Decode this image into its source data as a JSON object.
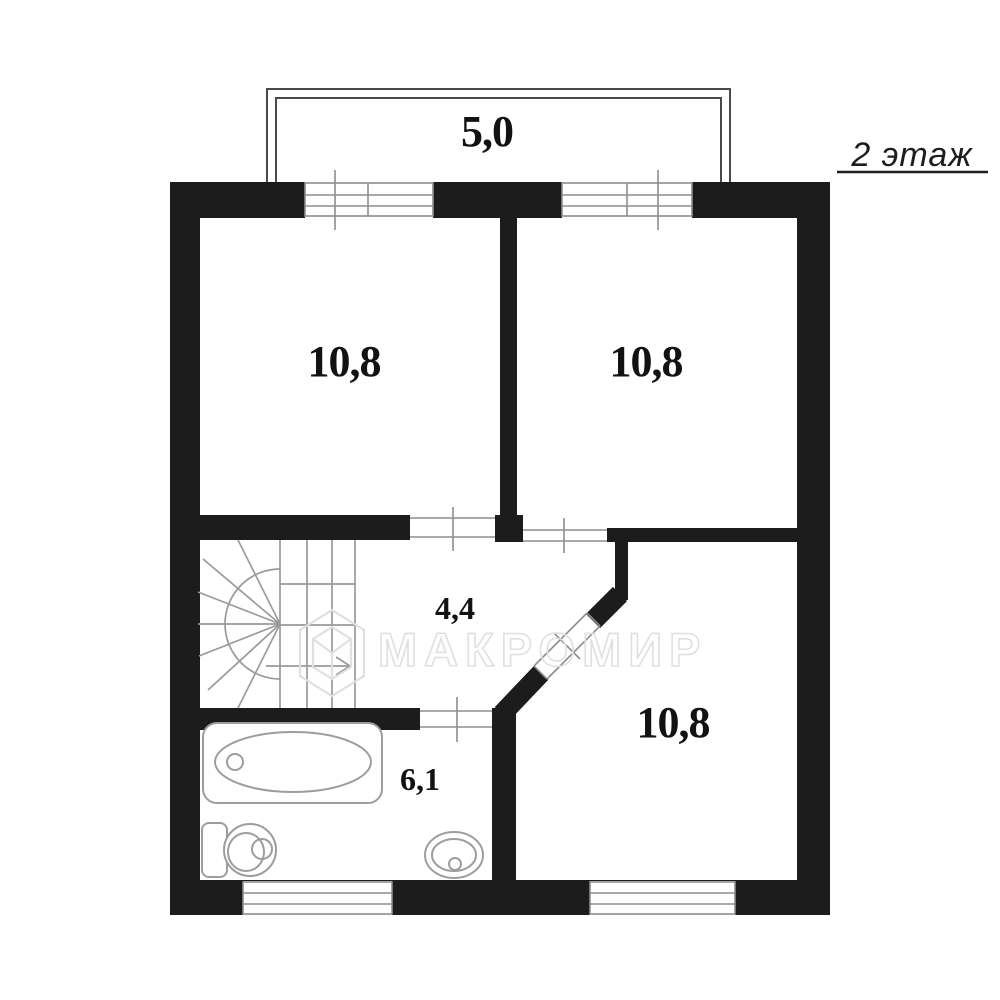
{
  "page": {
    "floor_label": "2 этаж"
  },
  "balcony": {
    "area_label": "5,0"
  },
  "rooms": {
    "top_left": {
      "area_label": "10,8"
    },
    "top_right": {
      "area_label": "10,8"
    },
    "hall": {
      "area_label": "4,4"
    },
    "bathroom": {
      "area_label": "6,1"
    },
    "bottom_right": {
      "area_label": "10,8"
    }
  },
  "watermark": {
    "text": "МАКРОМИР",
    "logo": "hexagon-cube-logo"
  },
  "colors": {
    "wall": "#1c1c1c",
    "thin_line": "#8d8d8d",
    "fixture_line": "#9d9d9d",
    "balcony_line": "#4a4a4a",
    "watermark": "#e0e0e0",
    "label_text": "#121212",
    "background": "#ffffff"
  }
}
